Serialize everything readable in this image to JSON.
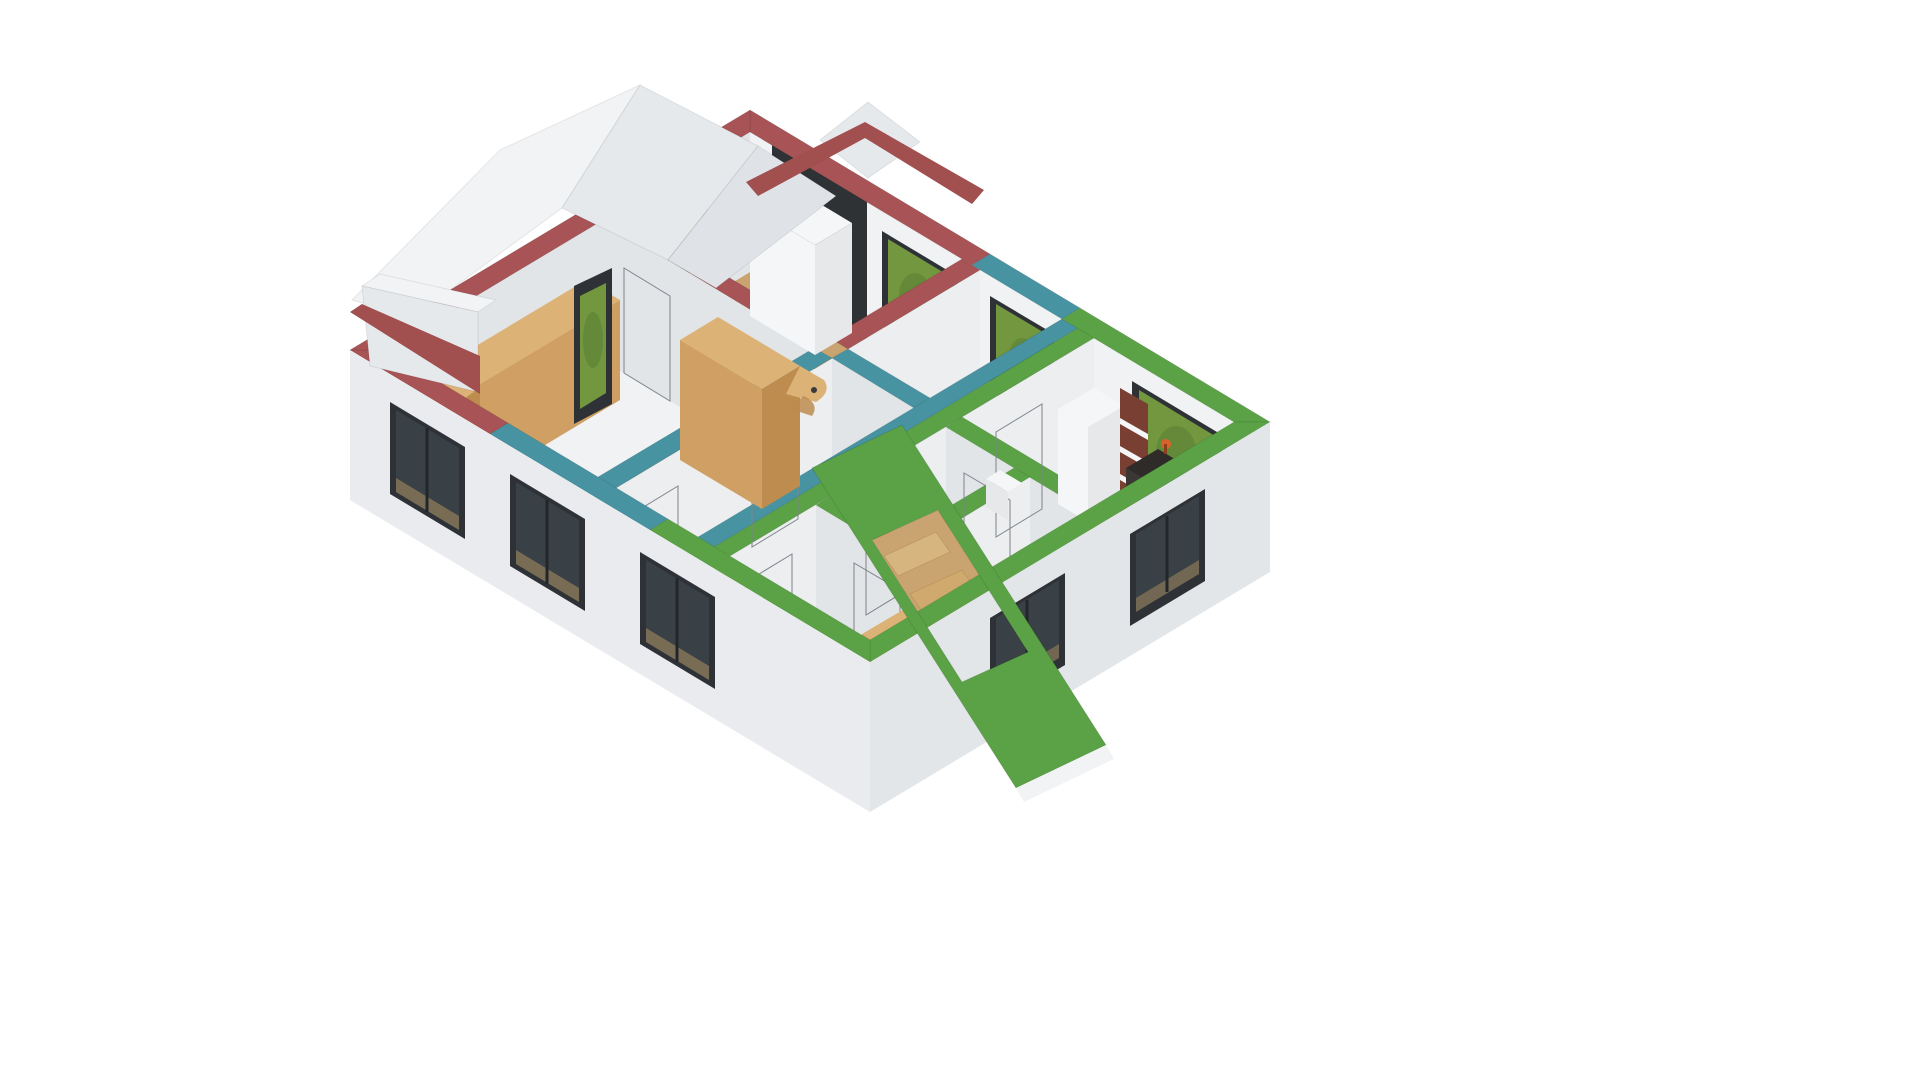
{
  "scene": {
    "kind": "3d-house-floor-plan-cutaway-render",
    "view": "isometric",
    "background": "#ffffff"
  },
  "materials": {
    "background": "#ffffff",
    "exterior_wall": "#e9ebee",
    "exterior_wall_shade": "#e2e6e9",
    "wall_face_lit": "#f0f2f4",
    "wall_face_shade": "#e2e5e8",
    "wall_face_mid": "#eceef0",
    "floor_base": "#eceae6",
    "wood_floor": "#c9a470",
    "wood_floor_line": "#8a6a3c",
    "pale_floor": "#efe9e0",
    "tile_floor": "#e9e6e1",
    "furniture_wood_top": "#dcb277",
    "furniture_wood_front": "#cf9f63",
    "furniture_wood_side": "#bd8c4e",
    "white_furniture": "#f5f6f8",
    "white_furniture_shade": "#e6e8ea",
    "dark_accent_wall": "#2f3235",
    "window_frame": "#2e3236",
    "window_glass": "#394146",
    "foliage": "#72973f",
    "foliage_shade": "#5a7d33",
    "door": "#9aa0a5",
    "door_edge": "#7e8489",
    "roof_white": "#f1f3f5",
    "roof_white_shade": "#e6e9ec",
    "roof_white_dark": "#dfe3e7",
    "red_fascia": "#a14f4f",
    "bookshelf_side": "#7a3f33",
    "desk_dark": "#2e2b29",
    "desk_dark_front": "#3b3734",
    "lamp_orange": "#d9622b",
    "shower_white": "#f4f5f6",
    "bed_pale": "#e3e7e9",
    "bed_stripe": "#a8cbc6"
  },
  "zones": [
    {
      "label": "red",
      "top": "#a85356",
      "area": "rear-left rooms"
    },
    {
      "label": "teal",
      "top": "#4793a2",
      "area": "middle rooms"
    },
    {
      "label": "green",
      "top": "#5aa245",
      "area": "front-right rooms and stair"
    }
  ],
  "elements": {
    "windows": [
      "gable-tall-window",
      "rear-left-window",
      "rear-window-red-room",
      "rear-window-teal-room",
      "rear-window-living",
      "front-left-window-1",
      "front-left-window-2",
      "front-left-window-3",
      "right-window-1",
      "right-window-2"
    ],
    "doors_count": 8,
    "furniture": [
      "oak-dresser",
      "oak-wardrobe",
      "corner-shelf",
      "white-closet",
      "nightstand",
      "kitchen-counter",
      "bookshelf",
      "desk",
      "desk-lamp",
      "shower-tray",
      "curved-staircase",
      "stair-treads",
      "oak-cabinet",
      "bed"
    ],
    "roof": [
      "white-gable-roof",
      "white-dormer",
      "red-fascia",
      "red-gable-band",
      "green-roof-slab-with-stair-opening"
    ]
  }
}
